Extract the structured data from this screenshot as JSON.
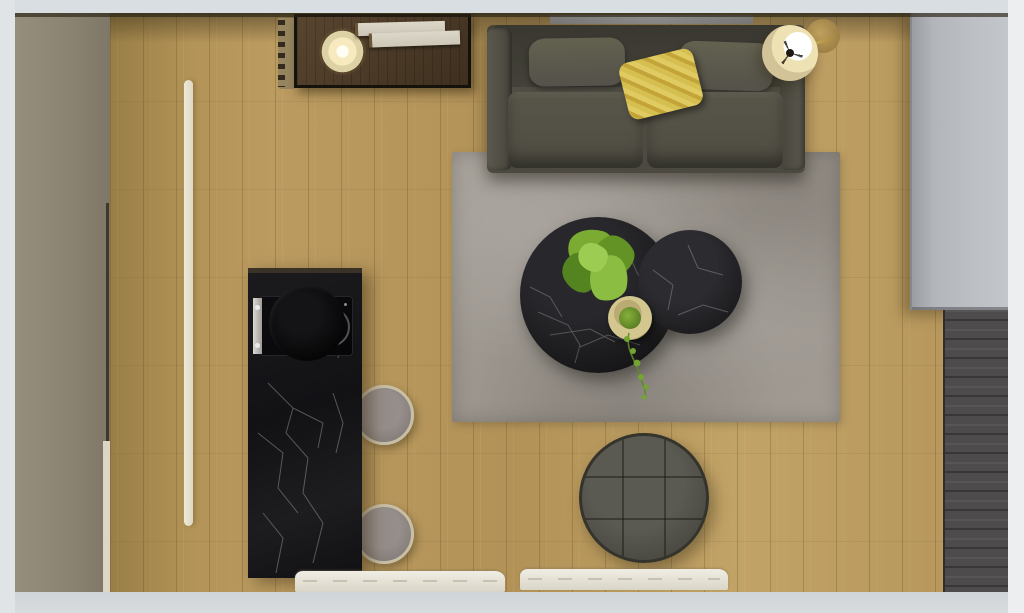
{
  "meta": {
    "type": "3d-interior-render-top-down",
    "description": "Photorealistic top-down (bird's-eye) 3D render of a small apartment living area: oak plank floor, dark sofa with yellow pillow, gray rug with two round black marble coffee tables and plants, round tufted ottoman, black marble kitchen island with cooktop and two bar stools, sideboard with lit lamp and books, floor lamp, gray wardrobe cabinet on the right.",
    "width_px": 1024,
    "height_px": 613,
    "visible_text": ""
  },
  "palette": {
    "frame_gray": "#d9dee3",
    "wood_floor": "#b7985c",
    "left_wall_taupe": "#8c8473",
    "sideboard_wood": "#4a3926",
    "sofa_fabric": "#504e44",
    "yellow_pillow": "#d6bf51",
    "rug_gray": "#9e9891",
    "marble_black": "#141417",
    "marble_vein_white": "#d8d8da",
    "stool_rim_tan": "#c9bfa6",
    "stool_seat_gray": "#8d8580",
    "ottoman_gray": "#4b4b44",
    "wardrobe_gray": "#b6b9be",
    "dark_panel": "#4d4b4b",
    "plant_green": "#7cab33",
    "lamp_glow": "#f8eabf",
    "lamp_shade_beige": "#d2c398",
    "mat_white": "#eae7dd",
    "led_strip_cream": "#e7e1d0"
  },
  "labels": {
    "scene": "Top-down render of living room and kitchenette",
    "floor": "Oak plank wood floor",
    "left_wall": "Left wall (taupe, seen from above)",
    "led_strip": "Recessed floor light strip",
    "radiator": "Wall radiator / slatted element",
    "sideboard": "Dark wood media sideboard",
    "table_lamp": "Lit round table lamp",
    "books": "Stacked books on sideboard",
    "wall_shelf": "Gray wall shelf above sofa",
    "sofa": "Dark gray two-seat fabric sofa",
    "back_pillow_left": "Left back cushion",
    "back_pillow_right": "Right back cushion",
    "yellow_pillow": "Yellow striped throw pillow",
    "seat_cushion_left": "Left seat cushion",
    "seat_cushion_right": "Right seat cushion",
    "floor_lamp": "Brass floor lamp with beige shade",
    "lamp_base": "Floor lamp wooden base",
    "wardrobe": "Light gray wardrobe cabinet (top view)",
    "dark_band": "Dark wood wall panel (right side)",
    "rug": "Large mottled gray area rug",
    "coffee_table_large": "Large round black marble coffee table",
    "coffee_table_small": "Small round black marble coffee table",
    "plant_large": "Leafy green plant on coffee table",
    "plant_basket": "Small potted plant in woven basket",
    "vine": "Trailing vine from potted plant",
    "ottoman": "Round dark gray tufted ottoman",
    "island": "Black marble kitchen island",
    "cooktop": "Built-in black cooktop with pan",
    "burner_ring": "Induction burner ring",
    "metal_strip": "Stainless control strip",
    "stool_top": "Round bar stool (top)",
    "stool_bottom": "Round bar stool (bottom)",
    "mat_left": "White door mat / threshold (left)",
    "mat_right": "White door mat / threshold (right)"
  }
}
